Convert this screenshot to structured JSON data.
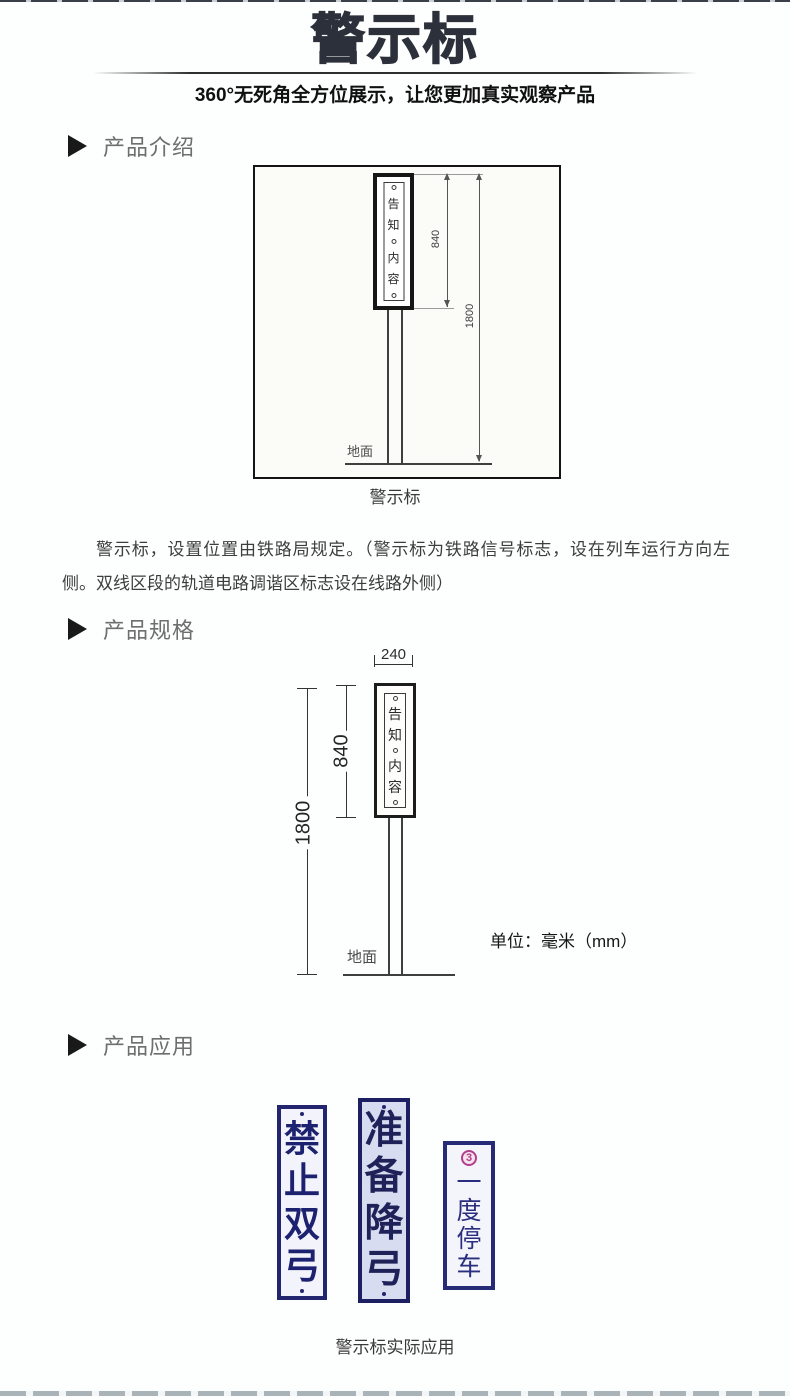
{
  "header": {
    "title": "警示标",
    "subtitle": "360°无死角全方位展示，让您更加真实观察产品"
  },
  "sections": {
    "intro_label": "产品介绍",
    "specs_label": "产品规格",
    "apps_label": "产品应用"
  },
  "notice_sign": {
    "chars": [
      "告",
      "知",
      "内",
      "容"
    ]
  },
  "diagram_intro": {
    "dim_sign_height": "840",
    "dim_total_height": "1800",
    "ground_label": "地面",
    "caption": "警示标"
  },
  "intro_text": "警示标，设置位置由铁路局规定。（警示标为铁路信号标志，设在列车运行方向左侧。双线区段的轨道电路调谐区标志设在线路外侧）",
  "diagram_specs": {
    "dim_width": "240",
    "dim_sign_height": "840",
    "dim_total_height": "1800",
    "ground_label": "地面",
    "unit_note": "单位：毫米（mm）"
  },
  "applications": {
    "signs": [
      {
        "name": "禁止双弓",
        "chars": [
          "禁",
          "止",
          "双",
          "弓"
        ]
      },
      {
        "name": "准备降弓",
        "chars": [
          "准",
          "备",
          "降",
          "弓"
        ]
      },
      {
        "name": "一度停车",
        "chars": [
          "一",
          "度",
          "停",
          "车"
        ],
        "emblem": "3"
      }
    ],
    "caption": "警示标实际应用"
  },
  "colors": {
    "sign_navy": "#23266e",
    "sign_bg_blue": "#d7dcf0",
    "emblem_magenta": "#b23f8c",
    "section_gray": "#6e6e6e",
    "title_dark": "#2c303a"
  }
}
